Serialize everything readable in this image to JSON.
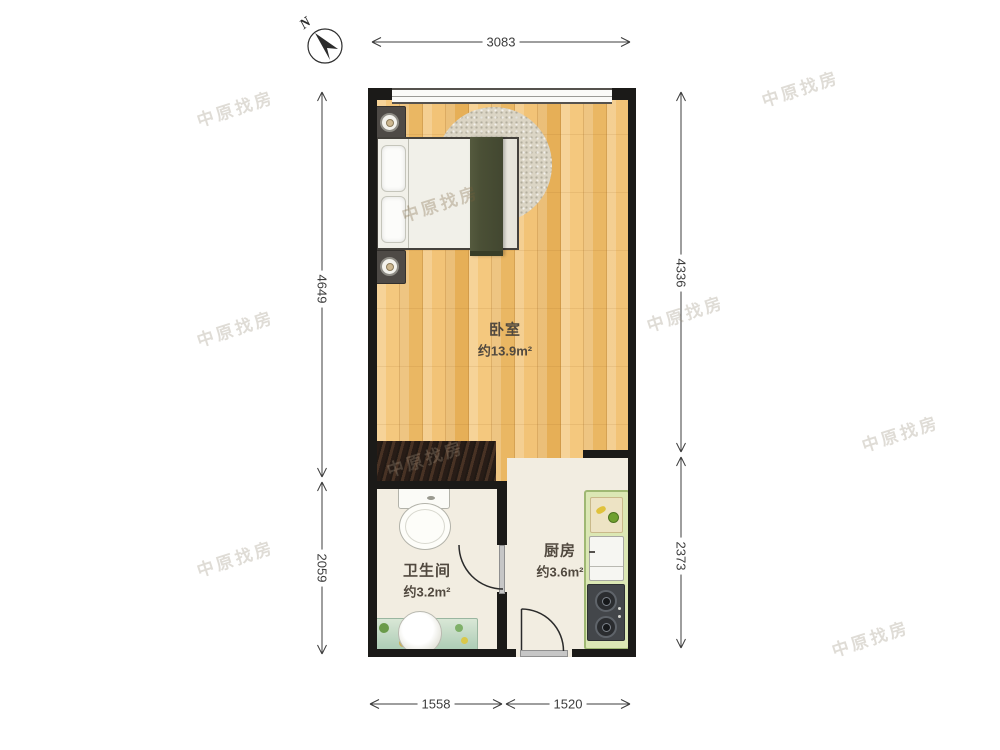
{
  "compass": {
    "label": "N"
  },
  "dimensions": {
    "top": "3083",
    "left_upper": "4649",
    "left_lower": "2059",
    "right_upper": "4336",
    "right_lower": "2373",
    "bottom_left": "1558",
    "bottom_right": "1520"
  },
  "rooms": {
    "bedroom": {
      "name": "卧室",
      "area": "约13.9m²"
    },
    "bathroom": {
      "name": "卫生间",
      "area": "约3.2m²"
    },
    "kitchen": {
      "name": "厨房",
      "area": "约3.6m²"
    }
  },
  "watermark": {
    "text": "中原找房"
  },
  "colors": {
    "wall": "#1b1a18",
    "wood_floor": "#f0c173",
    "tile_floor": "#f2ede1",
    "counter_green": "#dbe7b4",
    "blanket_olive": "#4b5036",
    "dimension_line": "#3c3c3c"
  }
}
